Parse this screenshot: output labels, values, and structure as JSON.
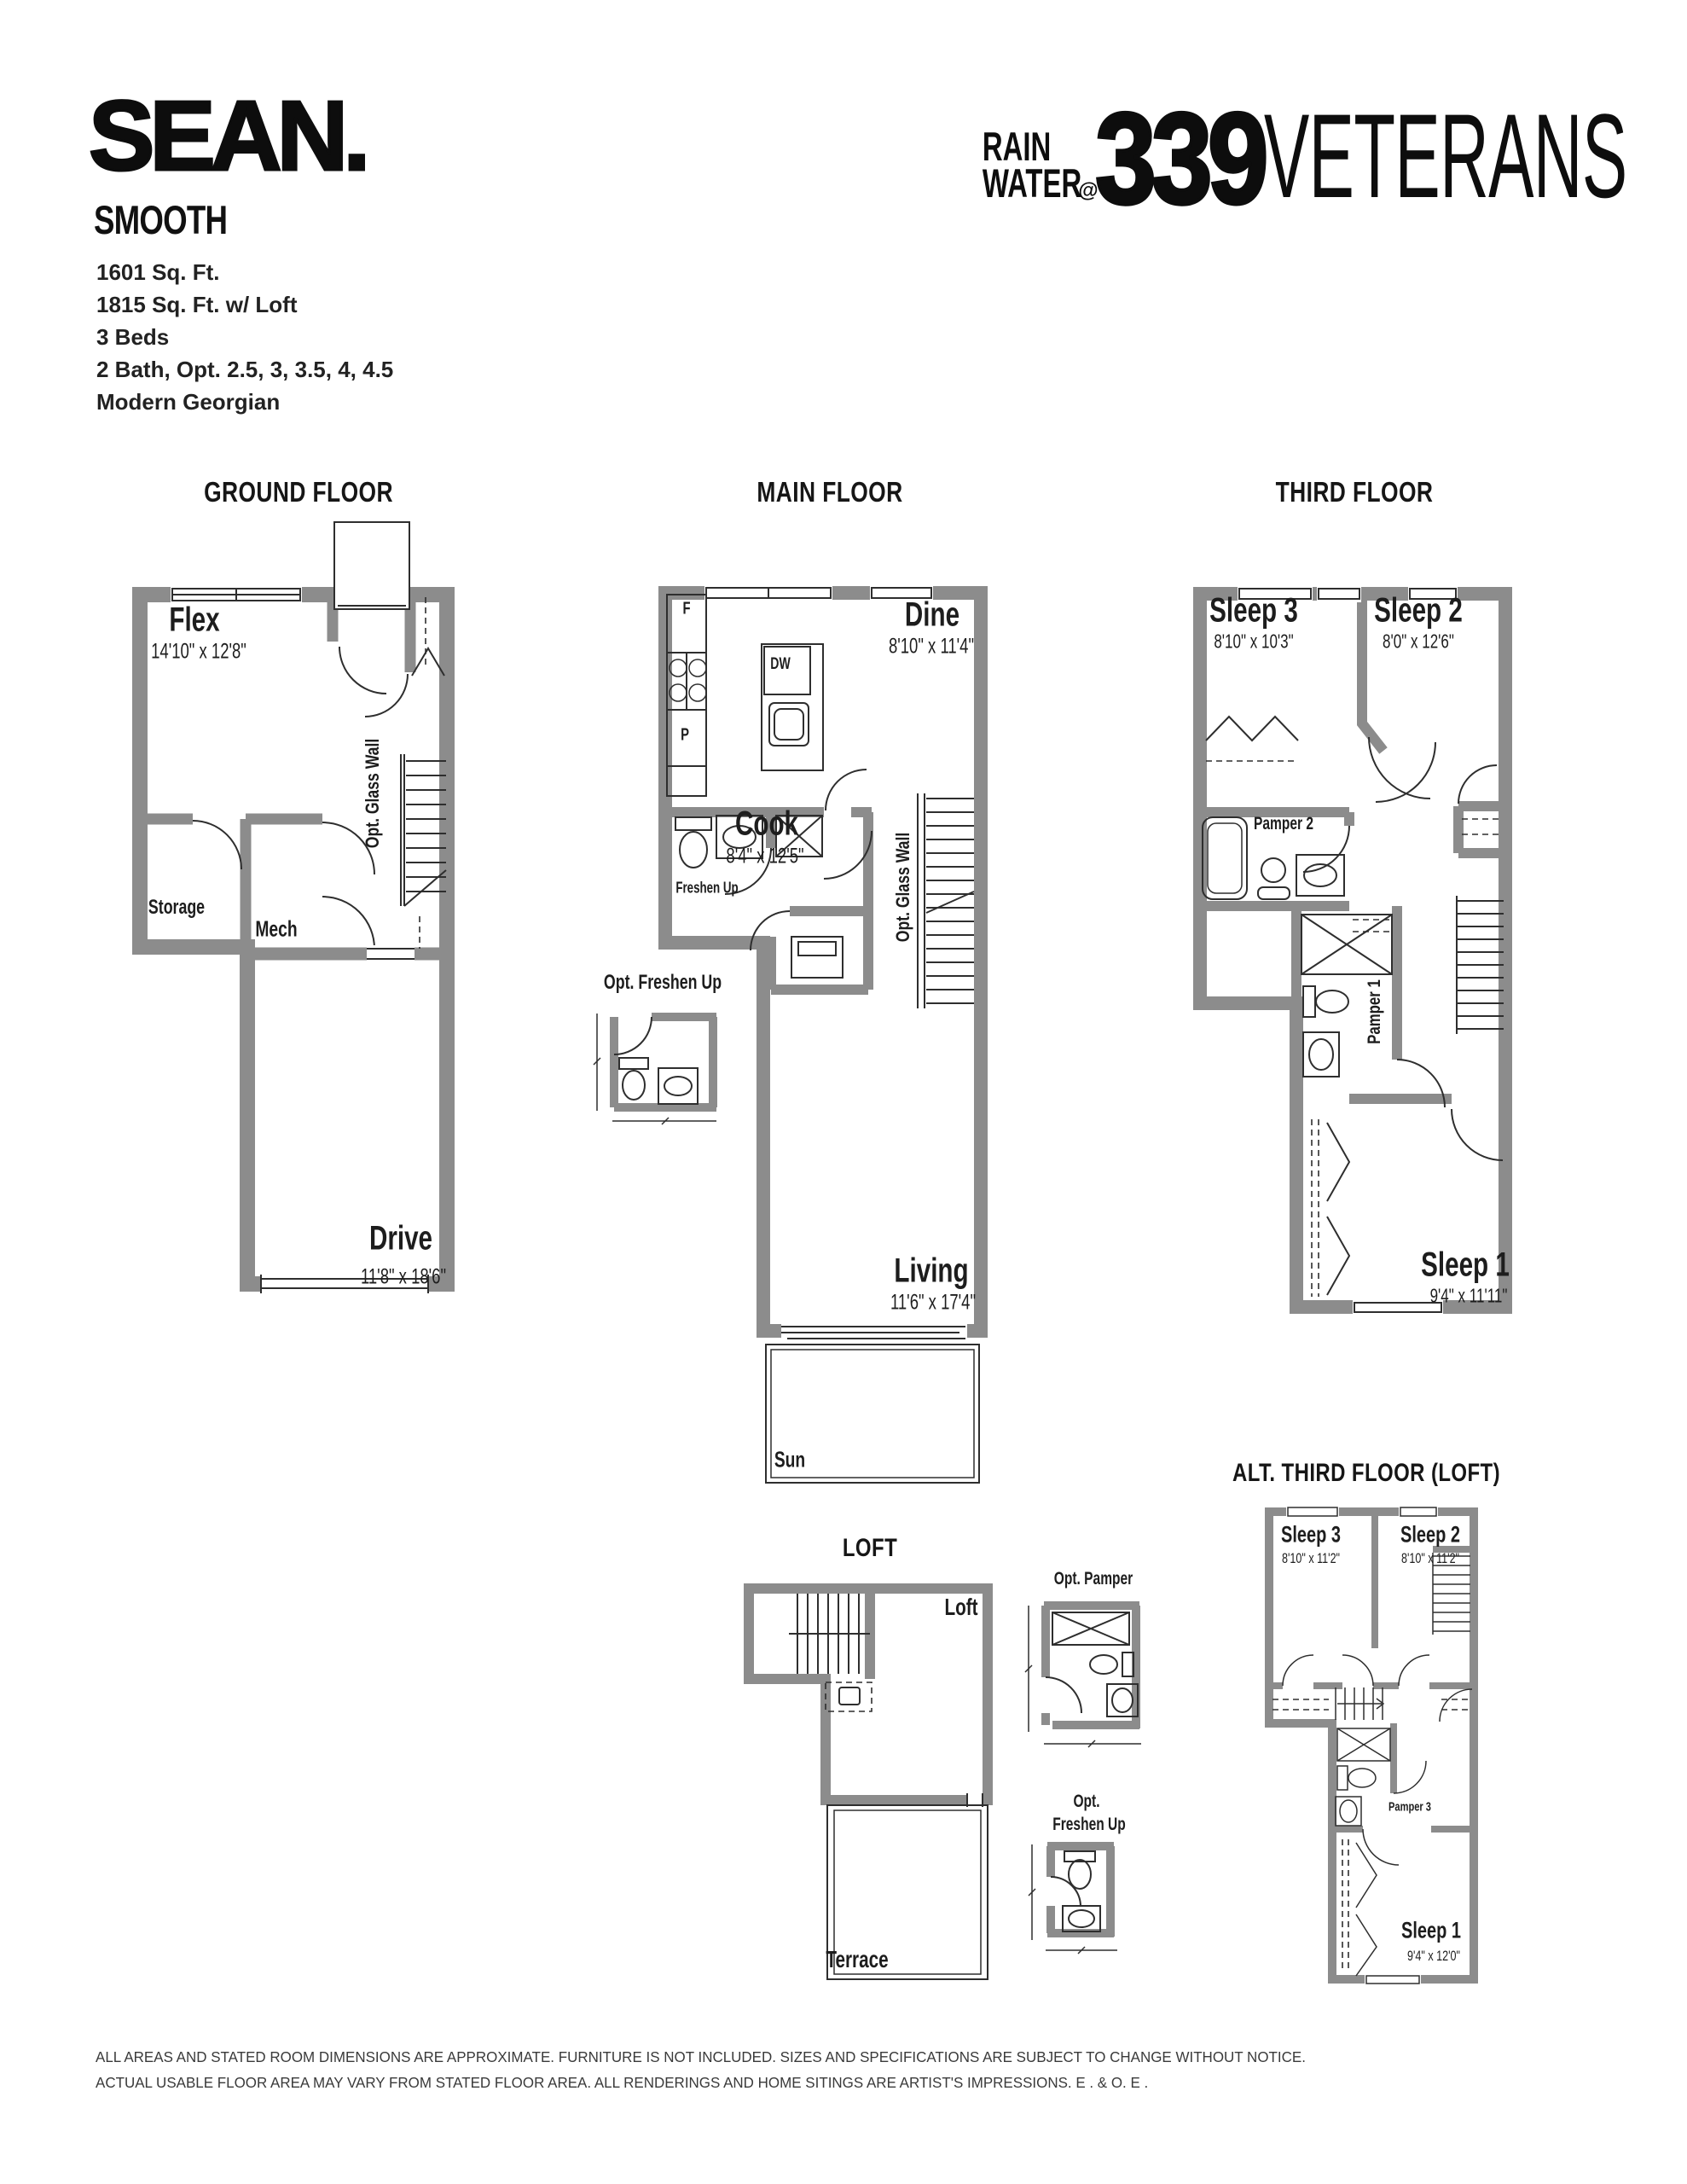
{
  "colors": {
    "wall_gray": "#8c8c8c",
    "line_dark": "#2e2e2e",
    "text_black": "#1d1d1d"
  },
  "header": {
    "brand": "SEAN.",
    "plan_name": "SMOOTH",
    "specs": [
      "1601 Sq. Ft.",
      "1815 Sq. Ft. w/ Loft",
      "3 Beds",
      "2 Bath, Opt. 2.5, 3, 3.5, 4, 4.5",
      "Modern Georgian"
    ],
    "logo": {
      "word1": "RAIN",
      "word2": "WATER",
      "at": "@",
      "number": "339",
      "name": "VETERANS"
    }
  },
  "floors": {
    "ground": {
      "title": "GROUND FLOOR",
      "flex": {
        "name": "Flex",
        "dims": "14'10\" x 12'8\""
      },
      "storage": "Storage",
      "mech": "Mech",
      "glass_wall": "Opt. Glass Wall",
      "drive": {
        "name": "Drive",
        "dims": "11'8\" x 18'6\""
      }
    },
    "main": {
      "title": "MAIN FLOOR",
      "fridge": "F",
      "dishwasher": "DW",
      "pantry": "P",
      "dine": {
        "name": "Dine",
        "dims": "8'10\" x 11'4\""
      },
      "cook": {
        "name": "Cook",
        "dims": "8'4\" x 12'5\""
      },
      "freshen_up": "Freshen Up",
      "opt_freshen_up": "Opt. Freshen Up",
      "glass_wall": "Opt. Glass Wall",
      "living": {
        "name": "Living",
        "dims": "11'6\" x 17'4\""
      },
      "sun": "Sun"
    },
    "third": {
      "title": "THIRD FLOOR",
      "sleep3": {
        "name": "Sleep 3",
        "dims": "8'10\" x 10'3\""
      },
      "sleep2": {
        "name": "Sleep 2",
        "dims": "8'0\" x 12'6\""
      },
      "pamper2": "Pamper 2",
      "pamper1": "Pamper 1",
      "sleep1": {
        "name": "Sleep 1",
        "dims": "9'4\" x 11'11\""
      }
    },
    "loft": {
      "title": "LOFT",
      "room": "Loft",
      "terrace": "Terrace"
    },
    "opt_pamper": {
      "title": "Opt. Pamper"
    },
    "opt_freshen_up": {
      "line1": "Opt.",
      "line2": "Freshen Up"
    },
    "alt_third": {
      "title": "ALT. THIRD FLOOR (LOFT)",
      "sleep3": {
        "name": "Sleep 3",
        "dims": "8'10\" x 11'2\""
      },
      "sleep2": {
        "name": "Sleep 2",
        "dims": "8'10\" x 11'2\""
      },
      "pamper3": "Pamper 3",
      "sleep1": {
        "name": "Sleep 1",
        "dims": "9'4\" x 12'0\""
      }
    }
  },
  "footer": {
    "line1": "ALL AREAS AND STATED ROOM DIMENSIONS ARE APPROXIMATE. FURNITURE IS NOT INCLUDED. SIZES AND SPECIFICATIONS ARE SUBJECT TO CHANGE WITHOUT NOTICE.",
    "line2": "ACTUAL USABLE FLOOR AREA MAY VARY FROM STATED FLOOR AREA. ALL RENDERINGS AND HOME SITINGS ARE ARTIST'S IMPRESSIONS. E . & O. E ."
  }
}
